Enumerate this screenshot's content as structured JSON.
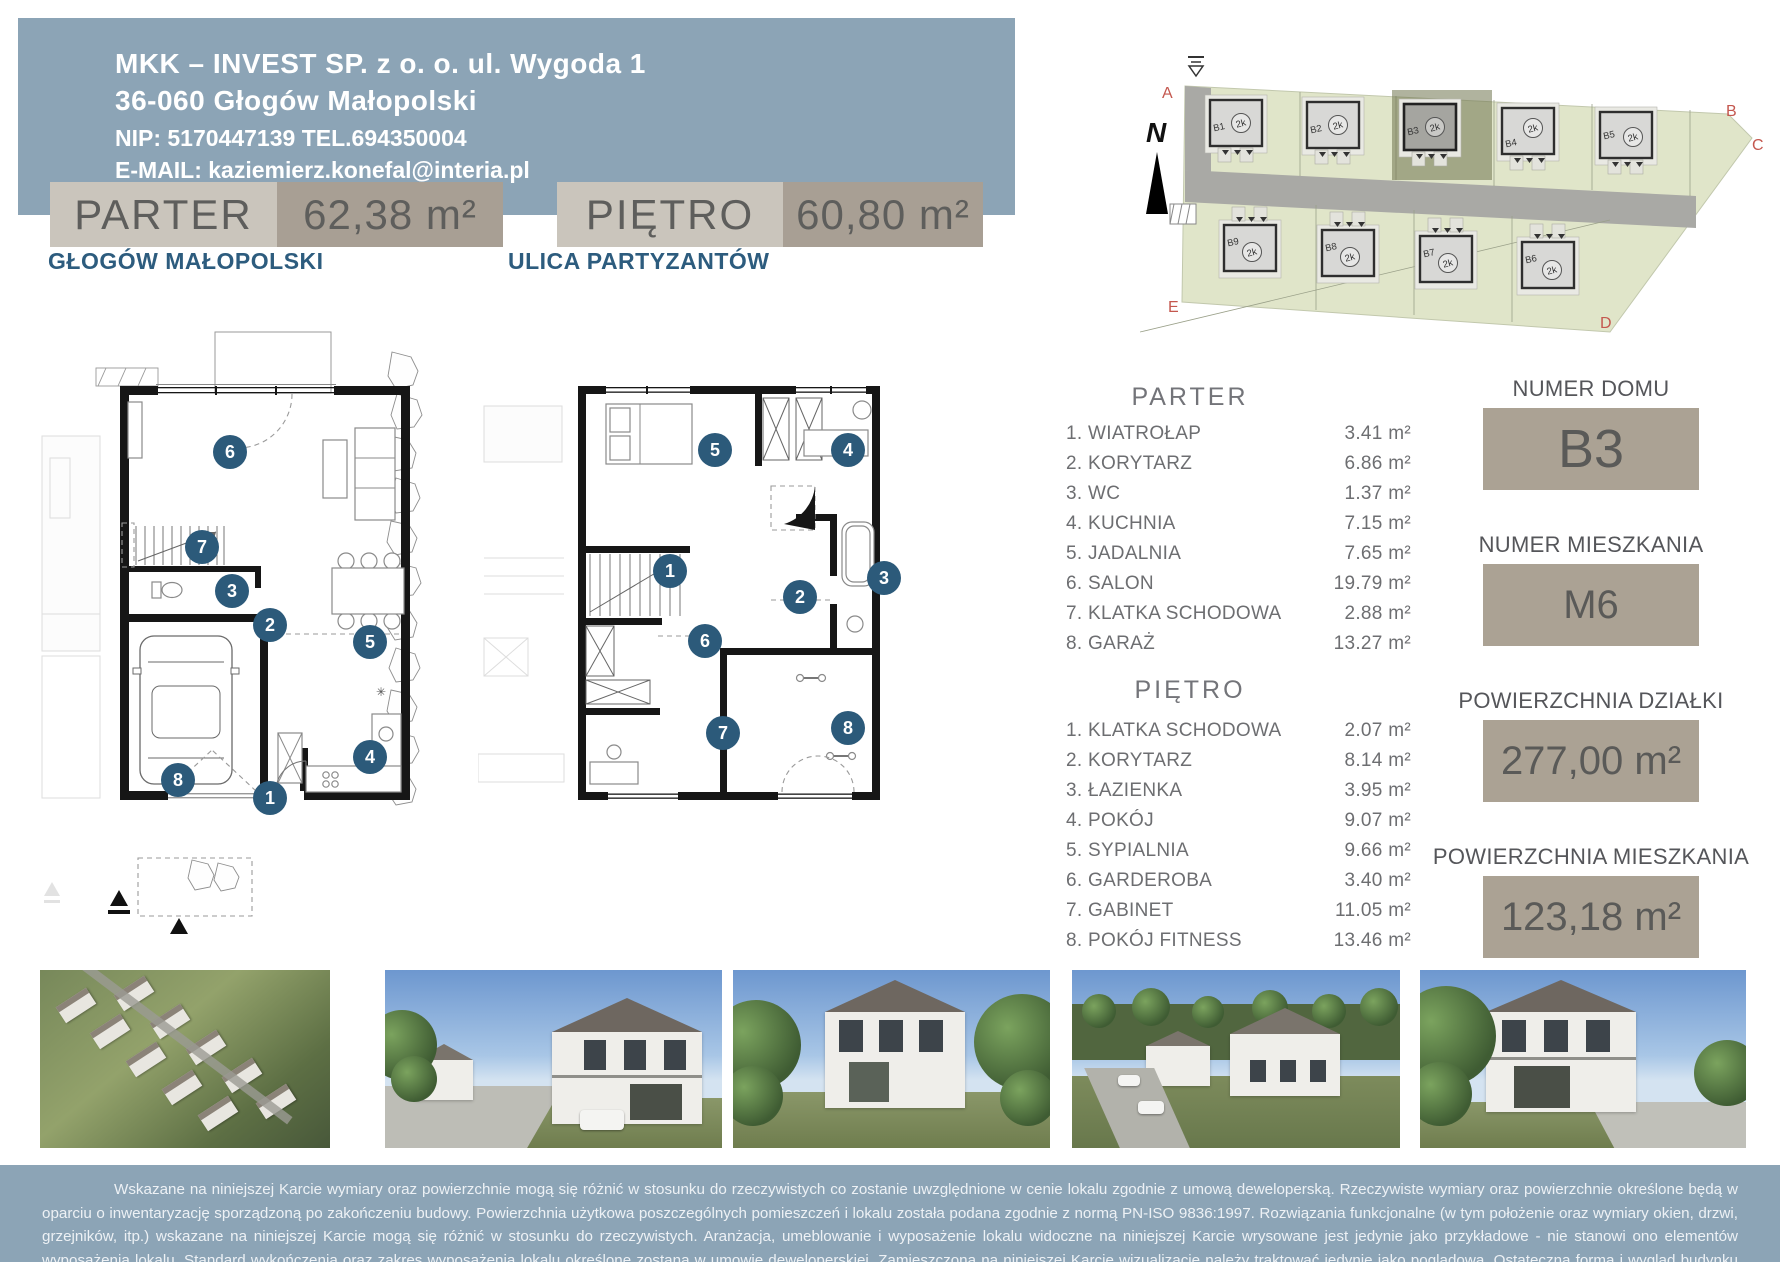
{
  "header": {
    "line1": "MKK – INVEST SP. z o. o. ul. Wygoda 1",
    "line2": "36-060 Głogów Małopolski",
    "line3": "NIP: 5170447139   TEL.694350004",
    "line4": "E-MAIL: kaziemierz.konefal@interia.pl"
  },
  "floor_tabs": {
    "parter": {
      "label": "PARTER",
      "area": "62,38 m²"
    },
    "pietro": {
      "label": "PIĘTRO",
      "area": "60,80 m²"
    }
  },
  "plan_titles": {
    "parter": "GŁOGÓW MAŁOPOLSKI",
    "pietro": "ULICA PARTYZANTÓW"
  },
  "rooms": {
    "parter": {
      "heading": "PARTER",
      "items": [
        {
          "name": "1. WIATROŁAP",
          "area": "3.41 m²"
        },
        {
          "name": "2. KORYTARZ",
          "area": "6.86 m²"
        },
        {
          "name": "3. WC",
          "area": "1.37 m²"
        },
        {
          "name": "4. KUCHNIA",
          "area": "7.15 m²"
        },
        {
          "name": "5. JADALNIA",
          "area": "7.65 m²"
        },
        {
          "name": "6. SALON",
          "area": "19.79 m²"
        },
        {
          "name": "7. KLATKA SCHODOWA",
          "area": "2.88 m²"
        },
        {
          "name": "8. GARAŻ",
          "area": "13.27 m²"
        }
      ]
    },
    "pietro": {
      "heading": "PIĘTRO",
      "items": [
        {
          "name": "1. KLATKA SCHODOWA",
          "area": "2.07 m²"
        },
        {
          "name": "2. KORYTARZ",
          "area": "8.14 m²"
        },
        {
          "name": "3. ŁAZIENKA",
          "area": "3.95 m²"
        },
        {
          "name": "4. POKÓJ",
          "area": "9.07 m²"
        },
        {
          "name": "5. SYPIALNIA",
          "area": "9.66 m²"
        },
        {
          "name": "6. GARDEROBA",
          "area": "3.40 m²"
        },
        {
          "name": "7. GABINET",
          "area": "11.05 m²"
        },
        {
          "name": "8. POKÓJ FITNESS",
          "area": "13.46 m²"
        }
      ]
    }
  },
  "plan_badges": {
    "parter": [
      "1",
      "2",
      "3",
      "4",
      "5",
      "6",
      "7",
      "8"
    ],
    "pietro": [
      "1",
      "2",
      "3",
      "4",
      "5",
      "6",
      "7",
      "8"
    ]
  },
  "unit_info": [
    {
      "label": "NUMER DOMU",
      "value": "B3"
    },
    {
      "label": "NUMER MIESZKANIA",
      "value": "M6"
    },
    {
      "label": "POWIERZCHNIA DZIAŁKI",
      "value": "277,00 m²"
    },
    {
      "label": "POWIERZCHNIA MIESZKANIA",
      "value": "123,18 m²"
    }
  ],
  "site_plan": {
    "north_label": "N",
    "unit_label": "2k",
    "boundary_letters": [
      "A",
      "B",
      "C",
      "D",
      "E"
    ],
    "houses_top": [
      "B1",
      "B2",
      "B3",
      "B4",
      "B5"
    ],
    "houses_bottom": [
      "B9",
      "B8",
      "B7",
      "B6"
    ],
    "highlighted_house": "B3"
  },
  "disclaimer": "Wskazane na niniejszej Karcie wymiary oraz powierzchnie mogą się różnić w stosunku do rzeczywistych co zostanie uwzględnione w cenie lokalu zgodnie z umową deweloperską. Rzeczywiste wymiary oraz powierzchnie określone będą w oparciu o inwentaryzację sporządzoną po zakończeniu budowy. Powierzchnia użytkowa poszczególnych pomieszczeń i lokalu została podana zgodnie z normą PN-ISO 9836:1997. Rozwiązania funkcjonalne (w tym położenie oraz wymiary okien, drzwi, grzejników, itp.) wskazane na niniejszej Karcie mogą się różnić w stosunku do rzeczywistych. Aranżacja, umeblowanie i wyposażenie lokalu widoczne na niniejszej Karcie wrysowane jest jedynie jako przykładowe - nie stanowi ono elementów wyposażenia lokalu. Standard wykończenia oraz zakres wyposażenia lokalu określone zostaną w umowie deweloperskiej. Zamieszczoną na niniejszej Karcie wizualizację należy traktować jedynie jako poglądową. Ostateczna forma i wygląd budynku mogą ulec zmianie.",
  "colors": {
    "header_bg": "#8ca4b6",
    "tab_light": "#cac5bc",
    "tab_dark": "#a89f94",
    "info_box": "#aba294",
    "accent_blue": "#2d5c7e",
    "badge_blue": "#2c5a7a",
    "boundary_red": "#c4574e",
    "site_green": "#e0e5c9"
  }
}
